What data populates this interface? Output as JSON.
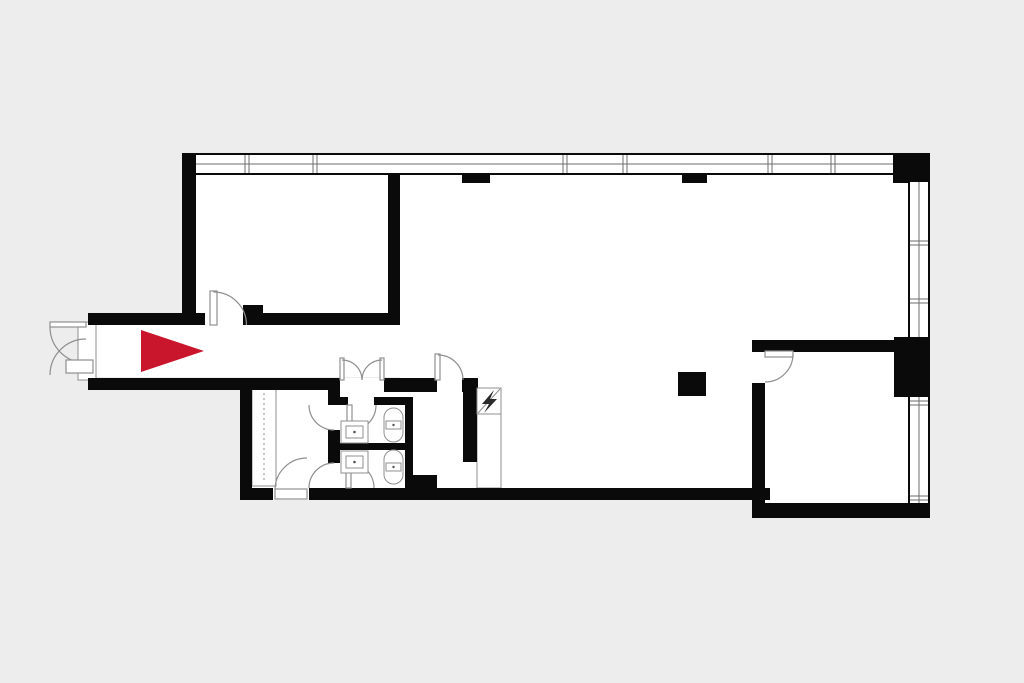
{
  "plan": {
    "type": "architectural-floor-plan",
    "orientation": "landscape"
  },
  "colors": {
    "background": "#ededed",
    "walls": "#0a0a0a",
    "floor": "#ffffff",
    "detail_lines": "#8f8f8f",
    "window_lines": "#6e6e6e",
    "accent": "#c9162c"
  },
  "icons": {
    "entrance_arrow": "right-pointing-triangle",
    "electrical_panel": "lightning-bolt",
    "wardrobe": "dashed-rail-line",
    "sink": "basin-with-tap-dot",
    "toilet": "stadium-bowl-with-flush"
  },
  "fixtures": {
    "sinks": 2,
    "toilets": 2,
    "door_swings": 11,
    "structural_columns": 1,
    "electrical_panels": 1,
    "wardrobes": 1
  }
}
